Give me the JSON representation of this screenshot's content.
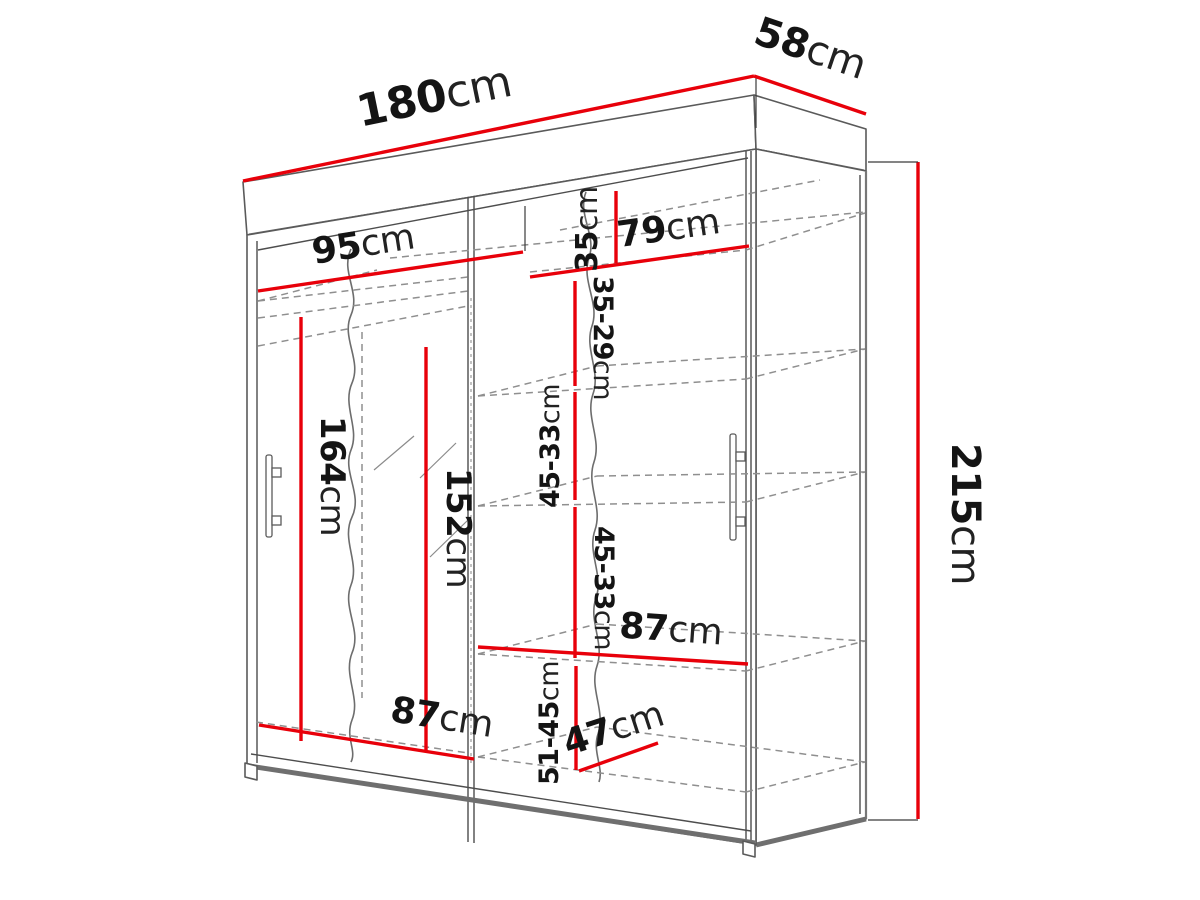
{
  "diagram": {
    "type": "furniture-dimension-drawing",
    "subject": "sliding-door wardrobe with mirror",
    "unit": "cm",
    "accent_color": "#e8000a",
    "line_color": "#6f6f6f",
    "text_color": "#141414"
  },
  "dims": {
    "total_width": {
      "value": "180",
      "unit": "cm"
    },
    "total_depth": {
      "value": "58",
      "unit": "cm"
    },
    "total_height": {
      "value": "215",
      "unit": "cm"
    },
    "left_shelf_width": {
      "value": "95",
      "unit": "cm"
    },
    "right_shelf_width": {
      "value": "79",
      "unit": "cm"
    },
    "top_gap": {
      "value": "35",
      "unit": "cm"
    },
    "gap_35_29": {
      "value": "35-29",
      "unit": "cm"
    },
    "gap_45_33_a": {
      "value": "45-33",
      "unit": "cm"
    },
    "gap_45_33_b": {
      "value": "45-33",
      "unit": "cm"
    },
    "gap_51_45": {
      "value": "51-45",
      "unit": "cm"
    },
    "hanging_height": {
      "value": "164",
      "unit": "cm"
    },
    "mirror_height": {
      "value": "152",
      "unit": "cm"
    },
    "bottom_left_width": {
      "value": "87",
      "unit": "cm"
    },
    "bottom_right_width": {
      "value": "87",
      "unit": "cm"
    },
    "bottom_depth": {
      "value": "47",
      "unit": "cm"
    }
  }
}
